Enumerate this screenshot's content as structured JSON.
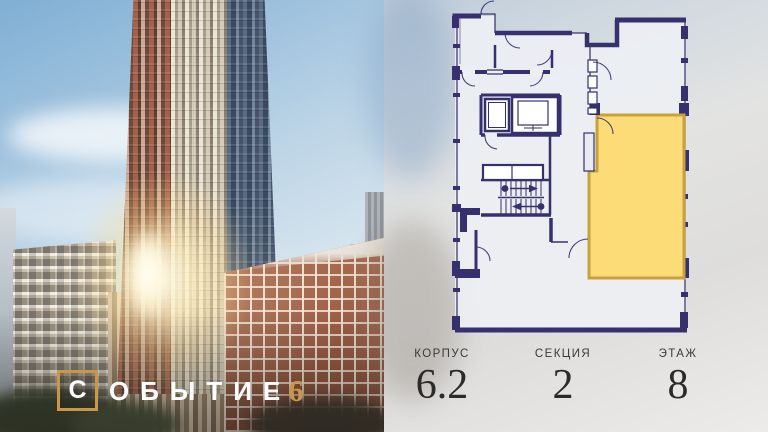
{
  "brand": {
    "boxed_letter": "С",
    "rest_letters": "ОБЫТИЕ",
    "number": "6",
    "gold_color": "#c9964a",
    "text_color": "#fdfdfd"
  },
  "plan": {
    "wall_color": "#37306f",
    "highlight_color": "#fbdc77",
    "highlight_border": "#c7a23c",
    "background_color": "#edeff3"
  },
  "info": [
    {
      "label": "КОРПУС",
      "value": "6.2"
    },
    {
      "label": "СЕКЦИЯ",
      "value": "2"
    },
    {
      "label": "ЭТАЖ",
      "value": "8"
    }
  ]
}
